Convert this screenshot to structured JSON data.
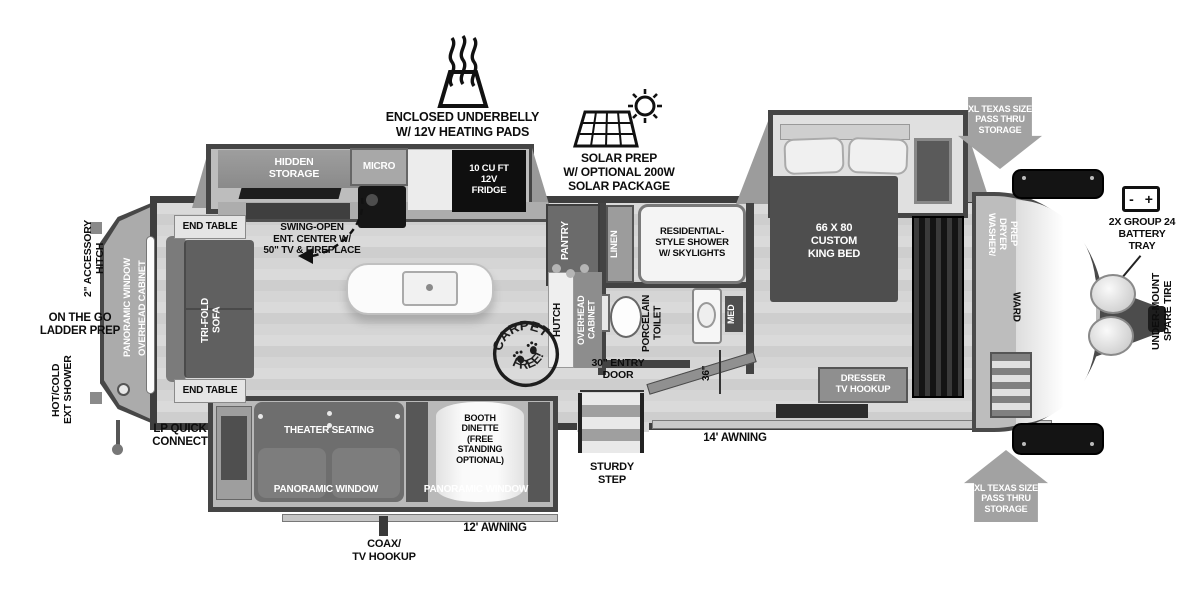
{
  "annotations": {
    "underbelly": "ENCLOSED UNDERBELLY\nW/ 12V HEATING PADS",
    "solar": "SOLAR PREP\nW/ OPTIONAL 200W\nSOLAR PACKAGE",
    "passthru_top": "XL TEXAS SIZE\nPASS THRU\nSTORAGE",
    "passthru_bottom": "XL TEXAS SIZE\nPASS THRU\nSTORAGE",
    "battery": "2X GROUP 24\nBATTERY\nTRAY",
    "spare_tire": "UNDER-MOUNT\nSPARE TIRE",
    "accessory_hitch": "2\" ACCESSORY\nHITCH",
    "ladder_prep": "ON THE GO\nLADDER PREP",
    "ext_shower": "HOT/COLD\nEXT SHOWER",
    "lp_quick": "LP QUICK\nCONNECT",
    "coax": "COAX/\nTV HOOKUP",
    "awning_12": "12' AWNING",
    "awning_14": "14' AWNING",
    "sturdy_step": "STURDY\nSTEP",
    "entry_door": "30\" ENTRY\nDOOR",
    "hall_width": "36\""
  },
  "kitchen": {
    "hidden_storage": "HIDDEN\nSTORAGE",
    "micro": "MICRO",
    "fridge": "10 CU FT\n12V\nFRIDGE",
    "swing_open": "SWING-OPEN\nENT. CENTER W/\n50\" TV & FIREPLACE",
    "pantry": "PANTRY",
    "hutch": "HUTCH",
    "hutch_overhead": "OVERHEAD\nCABINET",
    "stamp_top": "CARPET",
    "stamp_bottom": "FREE!"
  },
  "living": {
    "end_table_top": "END TABLE",
    "end_table_bottom": "END TABLE",
    "sofa": "TRI-FOLD\nSOFA",
    "rear_window": "PANORAMIC WINDOW",
    "rear_cabinet": "OVERHEAD CABINET",
    "theater": "THEATER SEATING",
    "theater_window": "PANORAMIC WINDOW",
    "dinette": "BOOTH\nDINETTE\n(FREE\nSTANDING\nOPTIONAL)",
    "dinette_window": "PANORAMIC WINDOW"
  },
  "bath": {
    "linen": "LINEN",
    "shower": "RESIDENTIAL-\nSTYLE SHOWER\nW/ SKYLIGHTS",
    "toilet": "PORCELAIN\nTOILET",
    "med": "MED"
  },
  "bedroom": {
    "bed": "66 X 80\nCUSTOM\nKING BED",
    "dresser": "DRESSER\nTV HOOKUP",
    "washer_dryer": "WASHER/\nDRYER\nPREP",
    "ward": "WARD"
  },
  "battery_icon": {
    "minus": "-",
    "plus": "+"
  }
}
